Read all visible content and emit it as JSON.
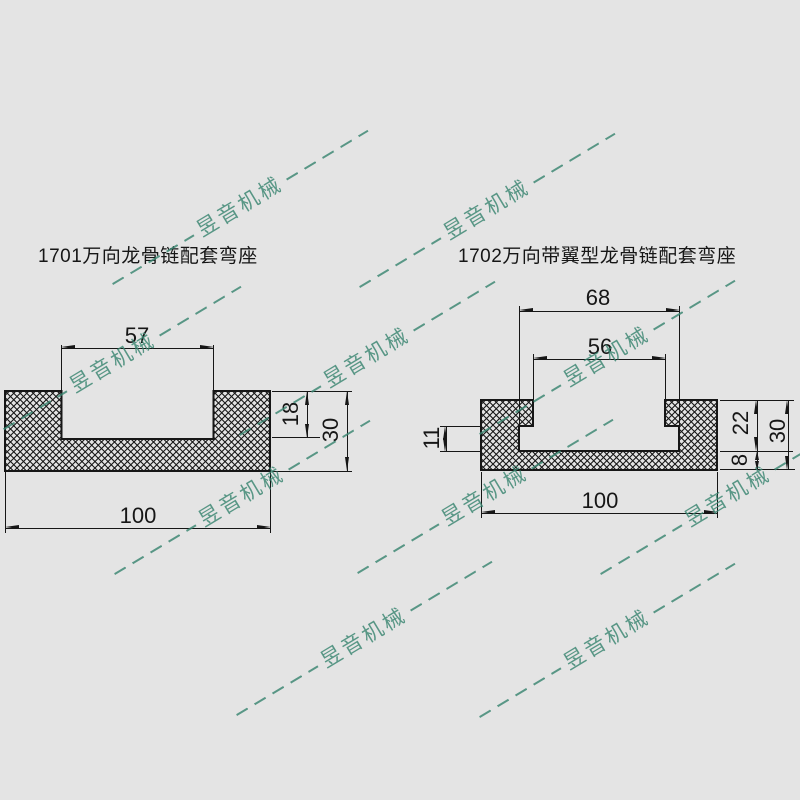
{
  "canvas": {
    "background": "#e4e4e4",
    "line_color": "#161616"
  },
  "watermark": {
    "text": "昱音机械",
    "color": "#3a8671",
    "opacity": 0.82,
    "angle_deg": -31,
    "positions": [
      {
        "x": 240,
        "y": 207
      },
      {
        "x": 487,
        "y": 210
      },
      {
        "x": 113,
        "y": 363
      },
      {
        "x": 367,
        "y": 358
      },
      {
        "x": 607,
        "y": 357
      },
      {
        "x": 242,
        "y": 497
      },
      {
        "x": 485,
        "y": 496
      },
      {
        "x": 728,
        "y": 497
      },
      {
        "x": 364,
        "y": 638
      },
      {
        "x": 607,
        "y": 640
      }
    ]
  },
  "d1701": {
    "title": "1701万向龙骨链配套弯座",
    "dims": {
      "slot_width": "57",
      "overall_width": "100",
      "slot_depth": "18",
      "overall_height": "30"
    }
  },
  "d1702": {
    "title": "1702万向带翼型龙骨链配套弯座",
    "dims": {
      "groove_width": "68",
      "slot_width": "56",
      "wing_step_height": "11",
      "wall_height": "22",
      "base_thickness": "8",
      "overall_height": "30",
      "overall_width": "100"
    }
  }
}
